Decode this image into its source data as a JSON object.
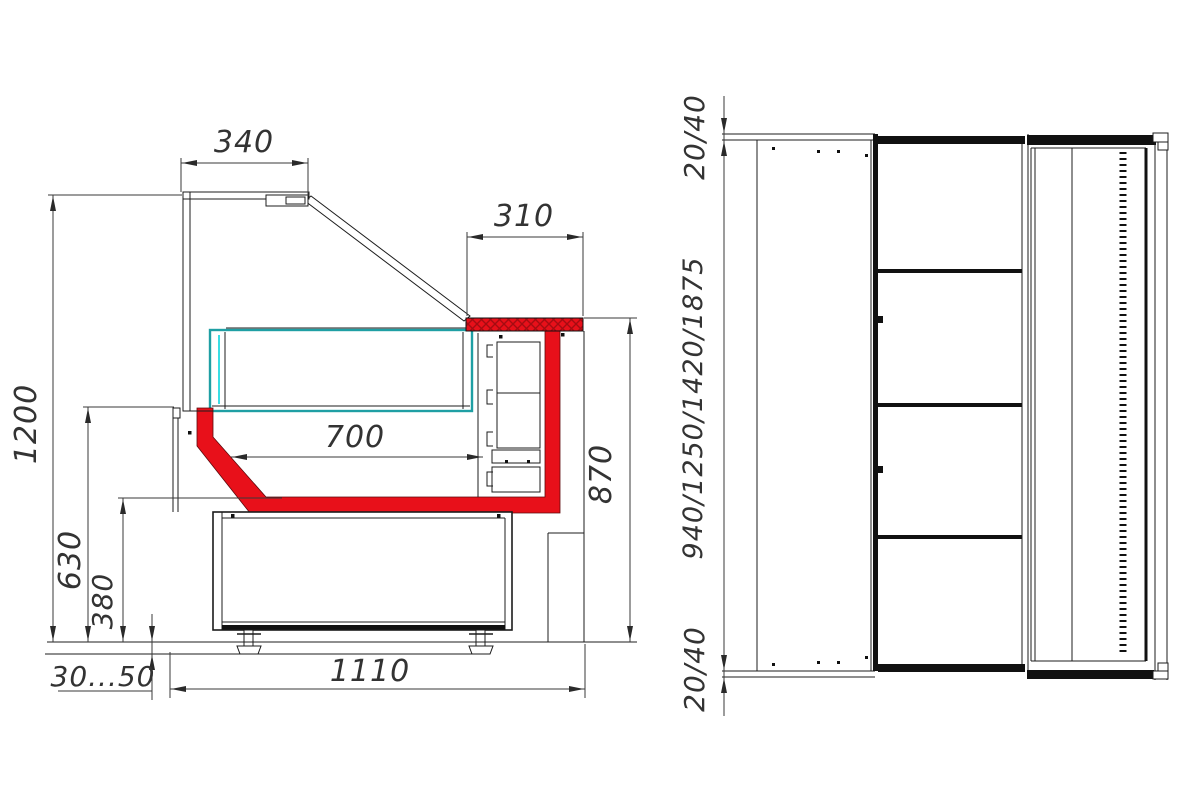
{
  "side_view": {
    "d340": "340",
    "d310": "310",
    "d1200": "1200",
    "d700": "700",
    "d630": "630",
    "d380": "380",
    "d870": "870",
    "dfeet": "30...50",
    "d1110": "1110"
  },
  "plan_view": {
    "dtop": "20/40",
    "dlen": "940/1250/1420/1875",
    "dbottom": "20/40"
  },
  "colors": {
    "glass": "#3adde4",
    "deck": "#1f9fa4",
    "red": "#e8101a",
    "red_dark": "#a50c12",
    "line": "#1c1c1c",
    "dim": "#3a3a3a"
  }
}
